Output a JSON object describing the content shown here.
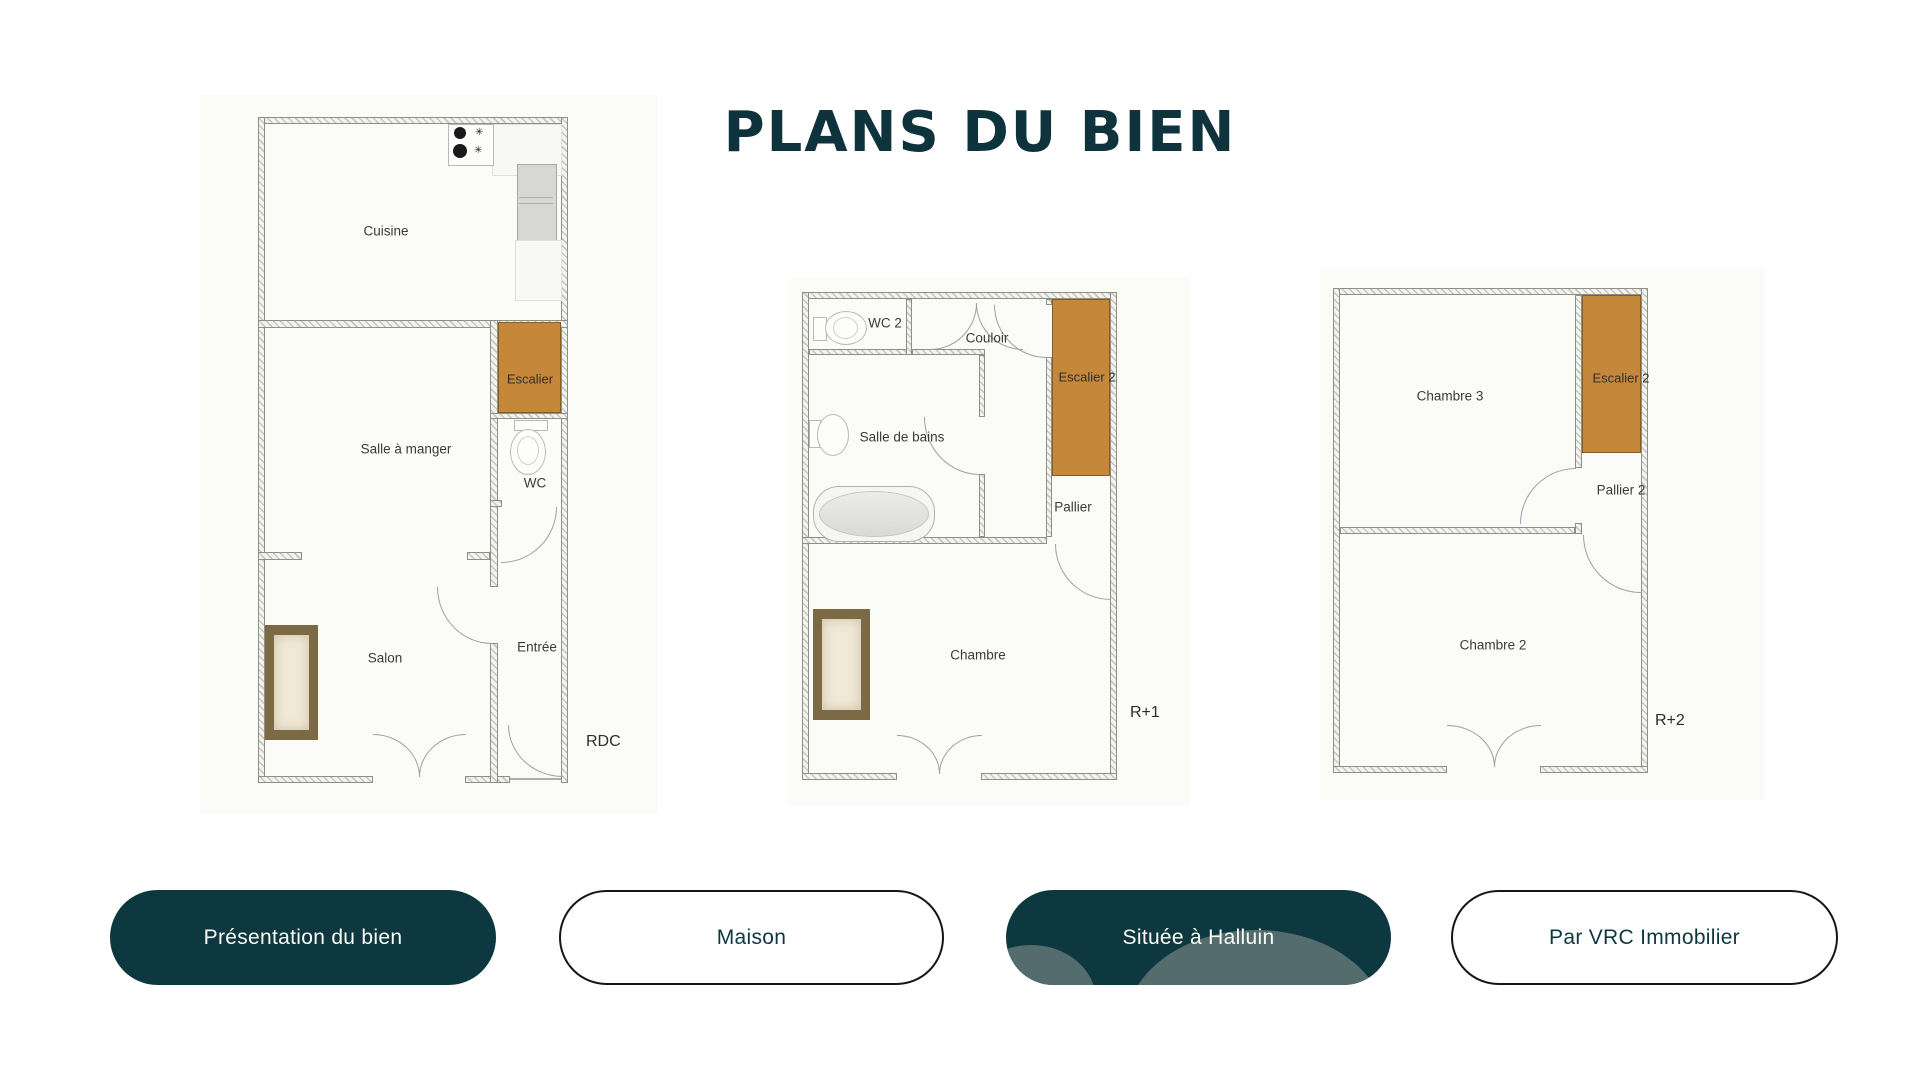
{
  "title": "PLANS DU BIEN",
  "colors": {
    "accent_dark_teal": "#0e3840",
    "stair_orange": "#c5873a",
    "blob_gray_teal": "#546c6e",
    "outline_black": "#161616",
    "title_teal": "#0f333d"
  },
  "icons": {
    "stove_spark": "✳"
  },
  "plans": [
    {
      "floor_label": "RDC",
      "rooms": {
        "cuisine": "Cuisine",
        "salle_a_manger": "Salle à manger",
        "escalier": "Escalier",
        "wc": "WC",
        "salon": "Salon",
        "entree": "Entrée"
      }
    },
    {
      "floor_label": "R+1",
      "rooms": {
        "wc2": "WC 2",
        "couloir": "Couloir",
        "escalier2": "Escalier 2",
        "salle_de_bains": "Salle de bains",
        "pallier": "Pallier",
        "chambre": "Chambre"
      }
    },
    {
      "floor_label": "R+2",
      "rooms": {
        "chambre3": "Chambre 3",
        "escalier2": "Escalier 2",
        "pallier2": "Pallier 2",
        "chambre2": "Chambre 2"
      }
    }
  ],
  "buttons": [
    {
      "label": "Présentation du bien",
      "style": "filled"
    },
    {
      "label": "Maison",
      "style": "outline"
    },
    {
      "label": "Située à Halluin",
      "style": "filled"
    },
    {
      "label": "Par VRC Immobilier",
      "style": "outline"
    }
  ]
}
